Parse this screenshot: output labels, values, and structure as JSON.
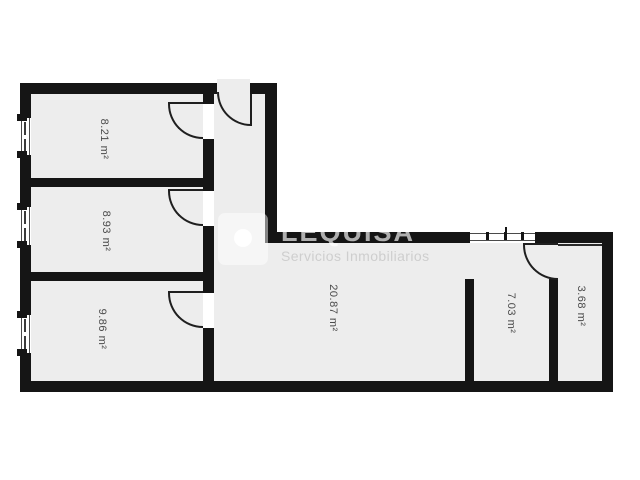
{
  "watermark": {
    "brand": "LEQUISA",
    "subtitle": "Servicios Inmobiliarios",
    "logo_icon": "circle-in-square-logo"
  },
  "rooms": [
    {
      "name": "room-top-left",
      "label": "8.21 m²"
    },
    {
      "name": "room-middle-left",
      "label": "8.93 m²"
    },
    {
      "name": "room-bottom-left",
      "label": "9.86 m²"
    },
    {
      "name": "room-main",
      "label": "20.87 m²"
    },
    {
      "name": "room-right",
      "label": "7.03 m²"
    },
    {
      "name": "room-far-right",
      "label": "3.68 m²"
    }
  ],
  "colors": {
    "wall": "#151515",
    "floor": "#ededed",
    "label_text": "#4b4b4b",
    "background": "#ffffff"
  }
}
